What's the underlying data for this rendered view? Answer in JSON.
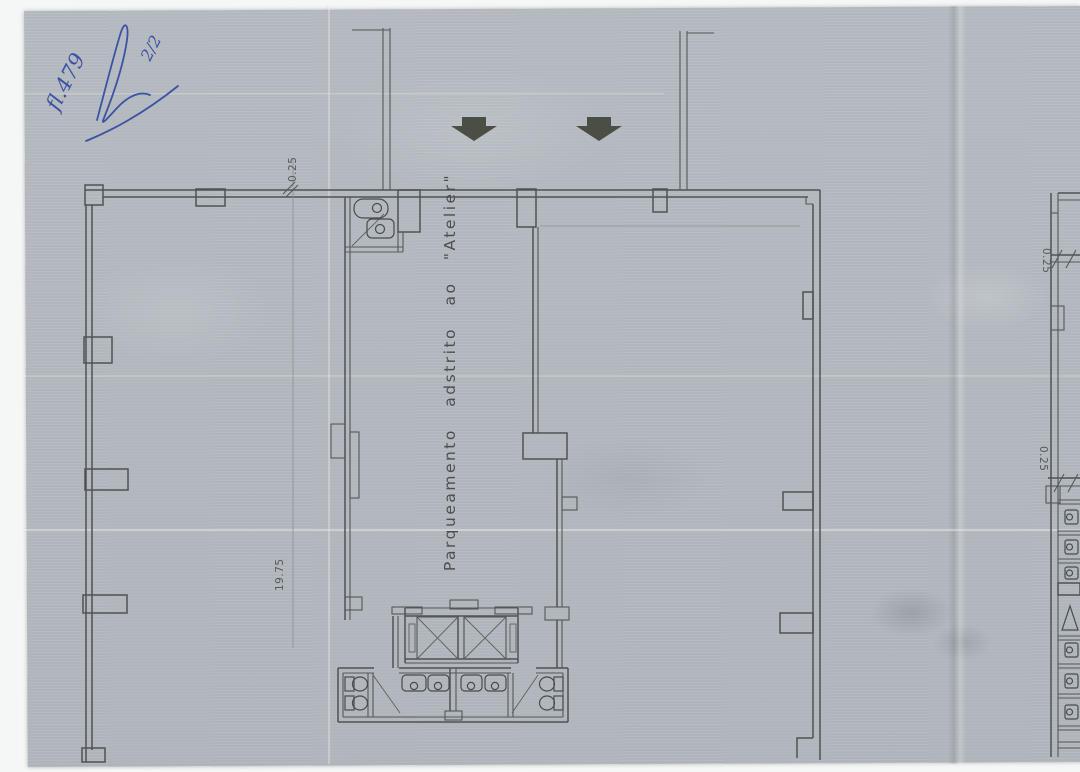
{
  "annotations": {
    "folio_number": "fl.479",
    "sheet_fraction": "2/2"
  },
  "plan": {
    "area_label": "Parqueamento adstrito ao \"Atelier\"",
    "dim_wall_top": "0.25",
    "dim_length": "19.75",
    "dim_right_upper": "0.25",
    "dim_right_lower": "0.25"
  },
  "icons": {
    "entrance_arrows": "down-arrow",
    "fixtures": [
      "toilet",
      "sink",
      "elevator-cross",
      "door-swing"
    ]
  },
  "colors": {
    "paper": "#b6bcc2",
    "plan_line": "#4f5357",
    "faint_line": "#8b9095",
    "arrow": "#4a4e44",
    "handwriting_ink": "#3c52a4",
    "margin_white": "#f5f6f6"
  }
}
